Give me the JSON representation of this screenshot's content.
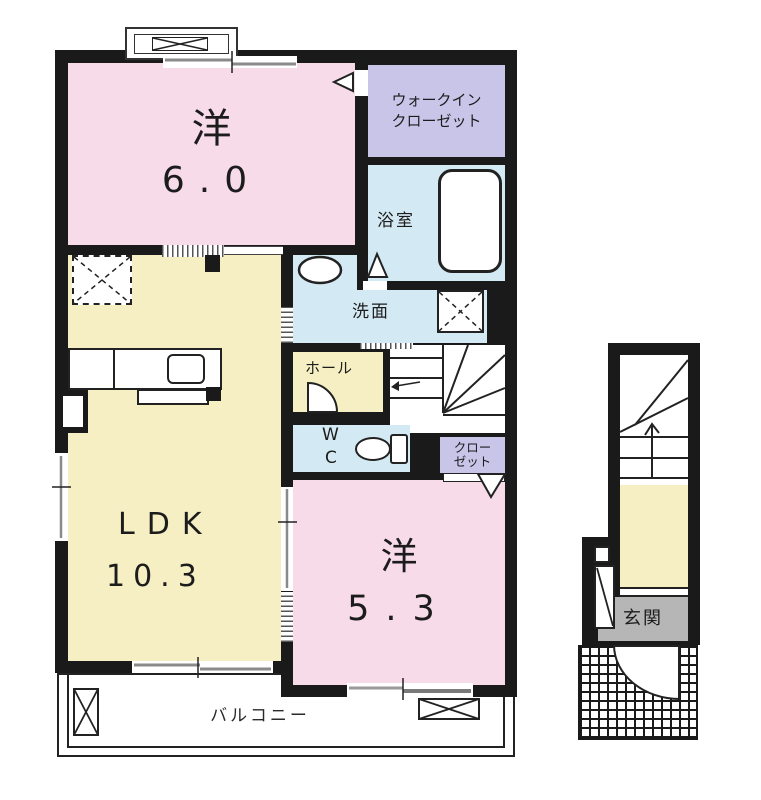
{
  "colors": {
    "wall": "#1a1a1a",
    "room_pink": "#f8dbe9",
    "room_yellow": "#f5efc3",
    "room_blue": "#d3e9f3",
    "room_purple": "#c9c5e9",
    "genkan_gray": "#b6b6b6"
  },
  "rooms": {
    "western6": {
      "name": "洋",
      "size": "6.0"
    },
    "wic": {
      "line1": "ウォークイン",
      "line2": "クローゼット"
    },
    "bath": {
      "name": "浴室"
    },
    "washroom": {
      "name": "洗面"
    },
    "hall": {
      "name": "ホール"
    },
    "wc": {
      "line1": "W",
      "line2": "C"
    },
    "closet": {
      "line1": "クロー",
      "line2": "ゼット"
    },
    "ldk": {
      "name": "LDK",
      "size": "10.3"
    },
    "western5": {
      "name": "洋",
      "size": "5.3"
    },
    "balcony": {
      "name": "バルコニー"
    },
    "genkan": {
      "name": "玄関"
    }
  }
}
